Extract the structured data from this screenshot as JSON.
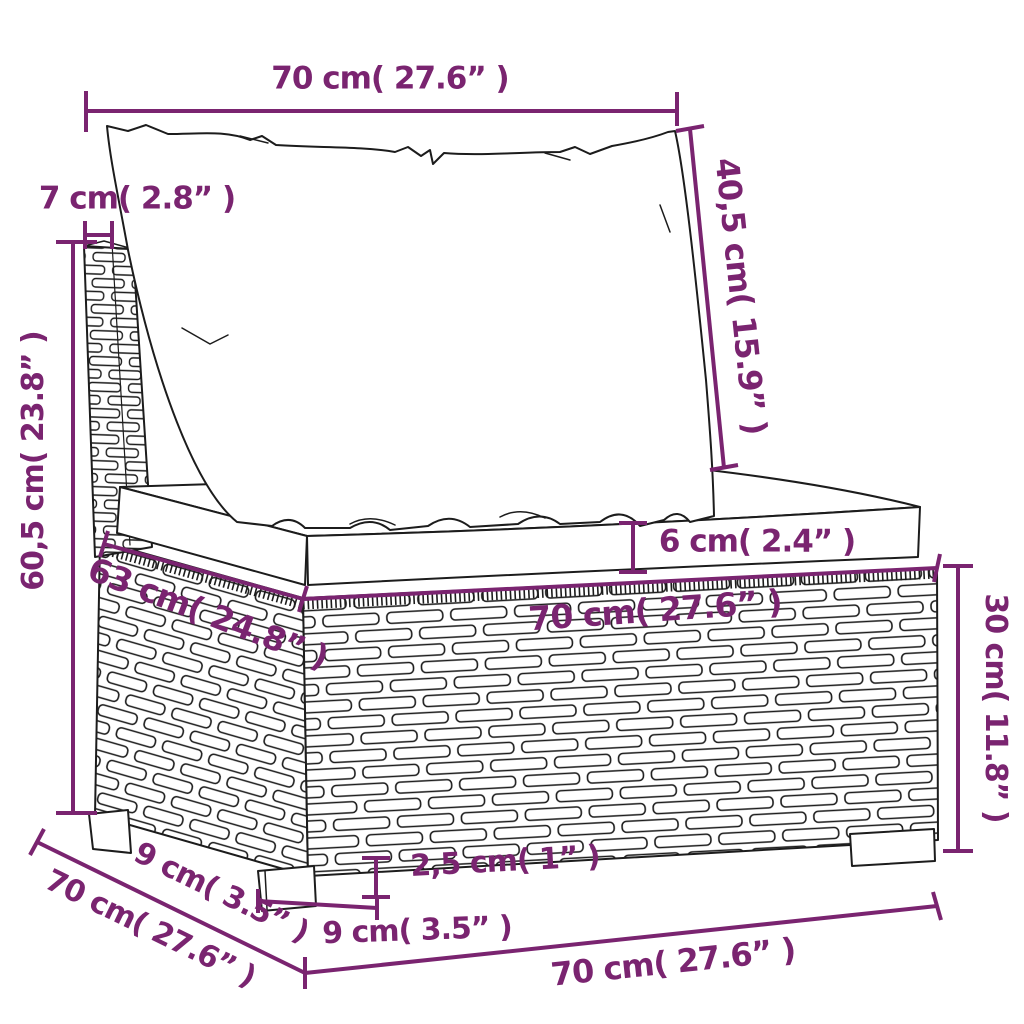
{
  "figure": {
    "kind": "product-dimension-diagram",
    "subject": "poly rattan sofa middle section with back cushion and seat cushion",
    "units": "cm / inches"
  },
  "colors": {
    "dimension_accent": "#7a2470",
    "line_art": "#1c1c1c",
    "background": "#ffffff"
  },
  "annotations": {
    "top_width": {
      "label": "70 cm( 27.6” )"
    },
    "back_depth": {
      "label": "7 cm( 2.8” )"
    },
    "back_cushion_height": {
      "label": "40,5 cm( 15.9” )"
    },
    "total_height": {
      "label": "60,5 cm( 23.8” )"
    },
    "seat_cushion_thickness": {
      "label": "6 cm( 2.4” )"
    },
    "seat_depth_top": {
      "label": "63 cm( 24.8” )"
    },
    "seat_width_top": {
      "label": "70 cm( 27.6” )"
    },
    "base_height": {
      "label": "30 cm( 11.8” )"
    },
    "rear_leg_inset": {
      "label": "9 cm( 3.5” )"
    },
    "depth_total": {
      "label": "70 cm( 27.6” )"
    },
    "leg_height": {
      "label": "2,5 cm( 1” )"
    },
    "front_leg_width": {
      "label": "9 cm( 3.5” )"
    },
    "bottom_width": {
      "label": "70 cm( 27.6” )"
    }
  }
}
